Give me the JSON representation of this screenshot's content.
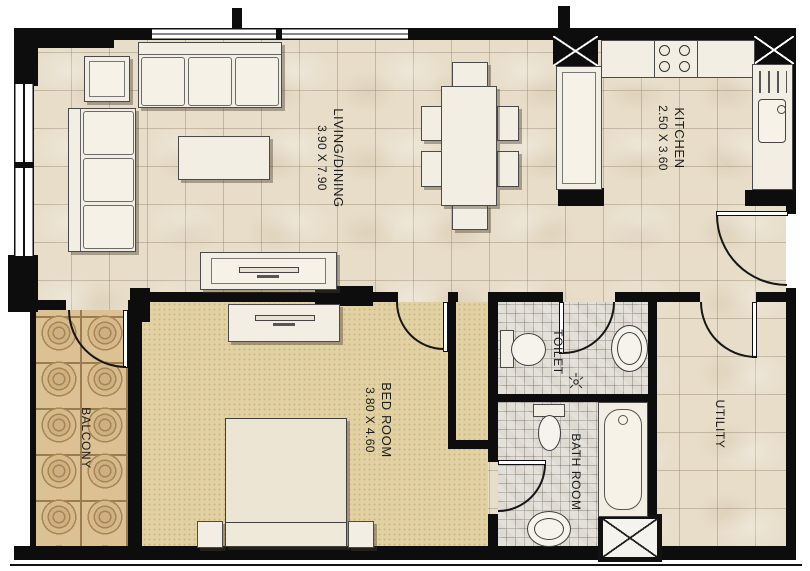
{
  "rooms": [
    {
      "name": "LIVING/DINING",
      "dims": "3.90 X 7.90"
    },
    {
      "name": "KITCHEN",
      "dims": "2.50 X 3.60"
    },
    {
      "name": "BED ROOM",
      "dims": "3.80 X 4.60"
    },
    {
      "name": "TOILET",
      "dims": ""
    },
    {
      "name": "BATH ROOM",
      "dims": ""
    },
    {
      "name": "UTILITY",
      "dims": ""
    },
    {
      "name": "BALCONY",
      "dims": ""
    }
  ],
  "colors": {
    "wall": "#0d0d0d",
    "floor_tile": "#e7ddc9",
    "bedroom_carpet": "#e2d1a3",
    "balcony_tile": "#dcc195",
    "wet_room_mosaic": "#dfdbd3",
    "furniture": "#f3eee3"
  }
}
